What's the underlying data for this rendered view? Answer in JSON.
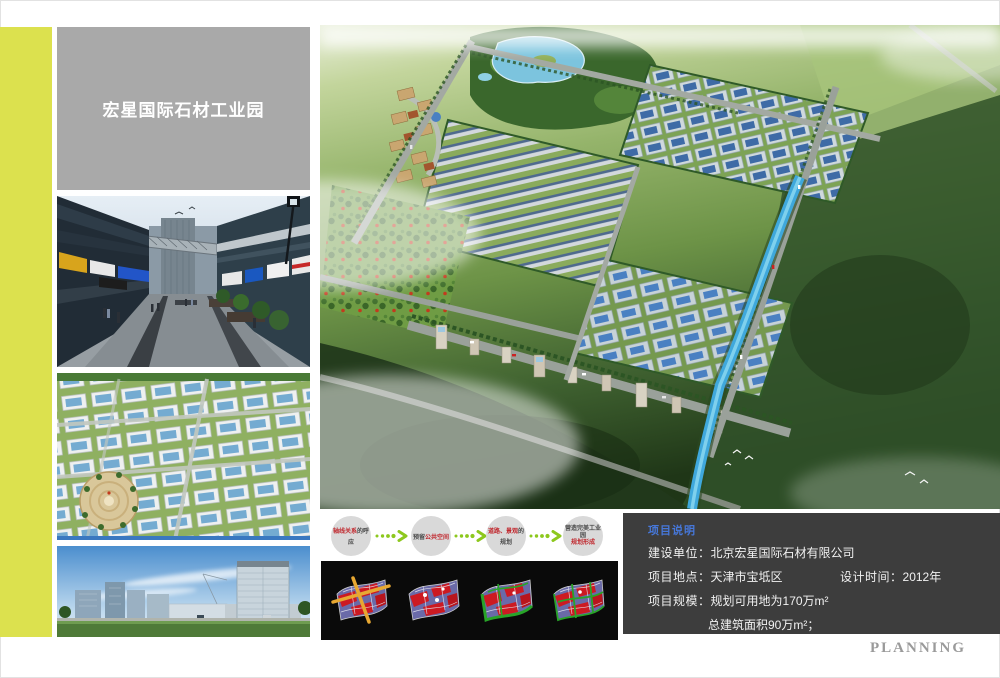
{
  "title_block": {
    "title": "宏星国际石材工业园"
  },
  "flow": {
    "steps": [
      {
        "red": "轴线关系",
        "dark": "的呼应"
      },
      {
        "dark": "预留",
        "red": "公共空间"
      },
      {
        "red": "道路、景观",
        "dark": "的规划"
      },
      {
        "dark": "营造完美工业园",
        "red": "规划形成"
      }
    ]
  },
  "project": {
    "heading": "项目说明",
    "rows": [
      {
        "label": "建设单位：",
        "value": "北京宏星国际石材有限公司"
      },
      {
        "label": "项目地点：",
        "value": "天津市宝坻区",
        "label2": "设计时间：",
        "value2": "2012年"
      },
      {
        "label": "项目规模：",
        "value": "规划可用地为170万m²"
      },
      {
        "label": "",
        "value": "总建筑面积90万m²；"
      }
    ]
  },
  "page": {
    "footer_brand": "PLANNING"
  },
  "colors": {
    "accent_bar": "#dce14e",
    "title_box": "#a9a9a9",
    "info_panel": "#3d3d3d",
    "heading_blue": "#4677d9",
    "flow_red": "#c0272d",
    "flow_green": "#8dc81e",
    "planning_gray": "#9a9a9a",
    "diagram_panel": "#0a0a0a",
    "photo_strip_blue": "#3a78c0"
  }
}
